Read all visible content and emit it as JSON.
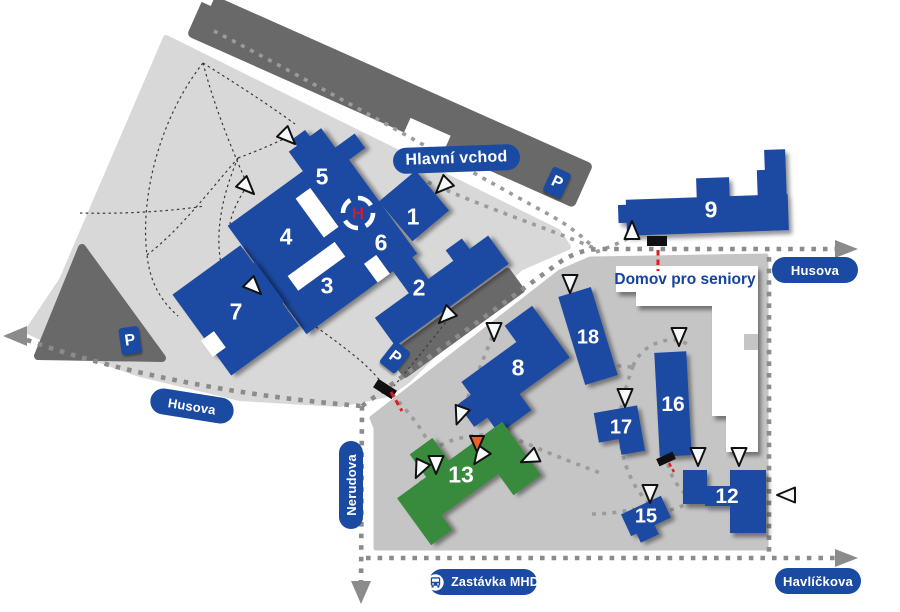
{
  "labels": {
    "main_entrance": "Hlavní vchod",
    "seniors_home": "Domov pro seniory",
    "bus_stop": "Zastávka MHD",
    "parking": "P",
    "helipad": "H"
  },
  "streets": {
    "husova_left": "Husova",
    "husova_right": "Husova",
    "nerudova": "Nerudova",
    "havlickova": "Havlíčkova"
  },
  "buildings": {
    "b1": "1",
    "b2": "2",
    "b3": "3",
    "b4": "4",
    "b5": "5",
    "b6": "6",
    "b7": "7",
    "b8": "8",
    "b9": "9",
    "b12": "12",
    "b13": "13",
    "b15": "15",
    "b16": "16",
    "b17": "17",
    "b18": "18"
  },
  "colors": {
    "building_blue": "#1a4aa2",
    "building_green": "#388a3c",
    "campus_left_gray": "#d8d8d8",
    "campus_right_gray": "#c5c5c5",
    "road_dark_gray": "#696969",
    "white_building": "#ffffff",
    "gate_red": "#e31b1c",
    "marker_orange": "#e8622a"
  }
}
